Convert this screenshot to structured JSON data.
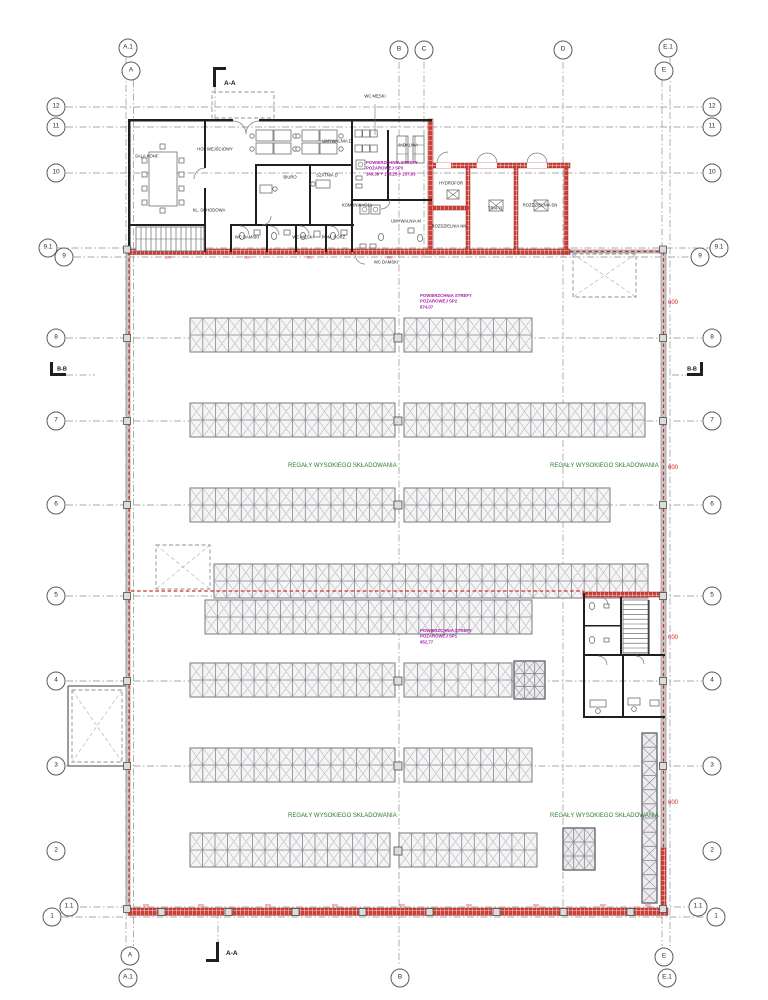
{
  "grid": {
    "A1": "A.1",
    "A": "A",
    "B": "B",
    "C": "C",
    "D": "D",
    "E": "E",
    "E1": "E.1",
    "n12": "12",
    "n11": "11",
    "n10": "10",
    "n91": "9.1",
    "n9": "9",
    "n8": "8",
    "n7": "7",
    "n6": "6",
    "n5": "5",
    "n4": "4",
    "n3": "3",
    "n2": "2",
    "n11b": "1.1",
    "n1": "1"
  },
  "sections": {
    "aa": "A-A",
    "bb": "B-B"
  },
  "rooms": {
    "sala_konf": "SALA KONF.",
    "hol": "HOL WEJŚCIOWY",
    "biuro": "BIURO",
    "szatnia_d": "SZATNIA D",
    "umywalnia_d": "UMYWALNIA D",
    "jadalnia": "JADALNIA",
    "komunikacja": "KOMUNIKACJA",
    "umywalnia_m": "UMYWALNIA M",
    "kl_schodowa": "KL. SCHODOWA",
    "wc_damski": "WC DAMSKI",
    "wc_meski": "WC MĘSKI",
    "pom_porz": "POM. PORZ.",
    "wc_damski_dolny": "WC DAMSKI",
    "hydrofor": "HYDROFOR",
    "trafo": "TRAFO",
    "rozdzielnia_sn": "ROZDZIELNIA SN",
    "rozdzielnia_nn": "ROZDZIELNIA NN"
  },
  "fire_zones": {
    "sp3": {
      "line1": "POWIERZCHNIA STREFY",
      "line2": "POŻAROWEJ SP3",
      "line3": "146,36 + 175,25 = 237,83"
    },
    "sp2": {
      "line1": "POWIERZCHNIA STREFY",
      "line2": "POŻAROWEJ SP2",
      "line3": "874,07"
    },
    "sp1": {
      "line1": "POWIERZCHNIA STREFY",
      "line2": "POŻAROWEJ SP1",
      "line3": "952,77"
    }
  },
  "annotations": {
    "dim": "600",
    "rack_note": "REGAŁY WYSOKIEGO SKŁADOWANIA"
  },
  "colors": {
    "fire_red": "#c43430",
    "zone_magenta": "#a81ba8",
    "dim_red": "#cc2727",
    "note_green": "#2e7d32",
    "wall_black": "#1f1f1f",
    "rack_gray": "#83838b"
  }
}
